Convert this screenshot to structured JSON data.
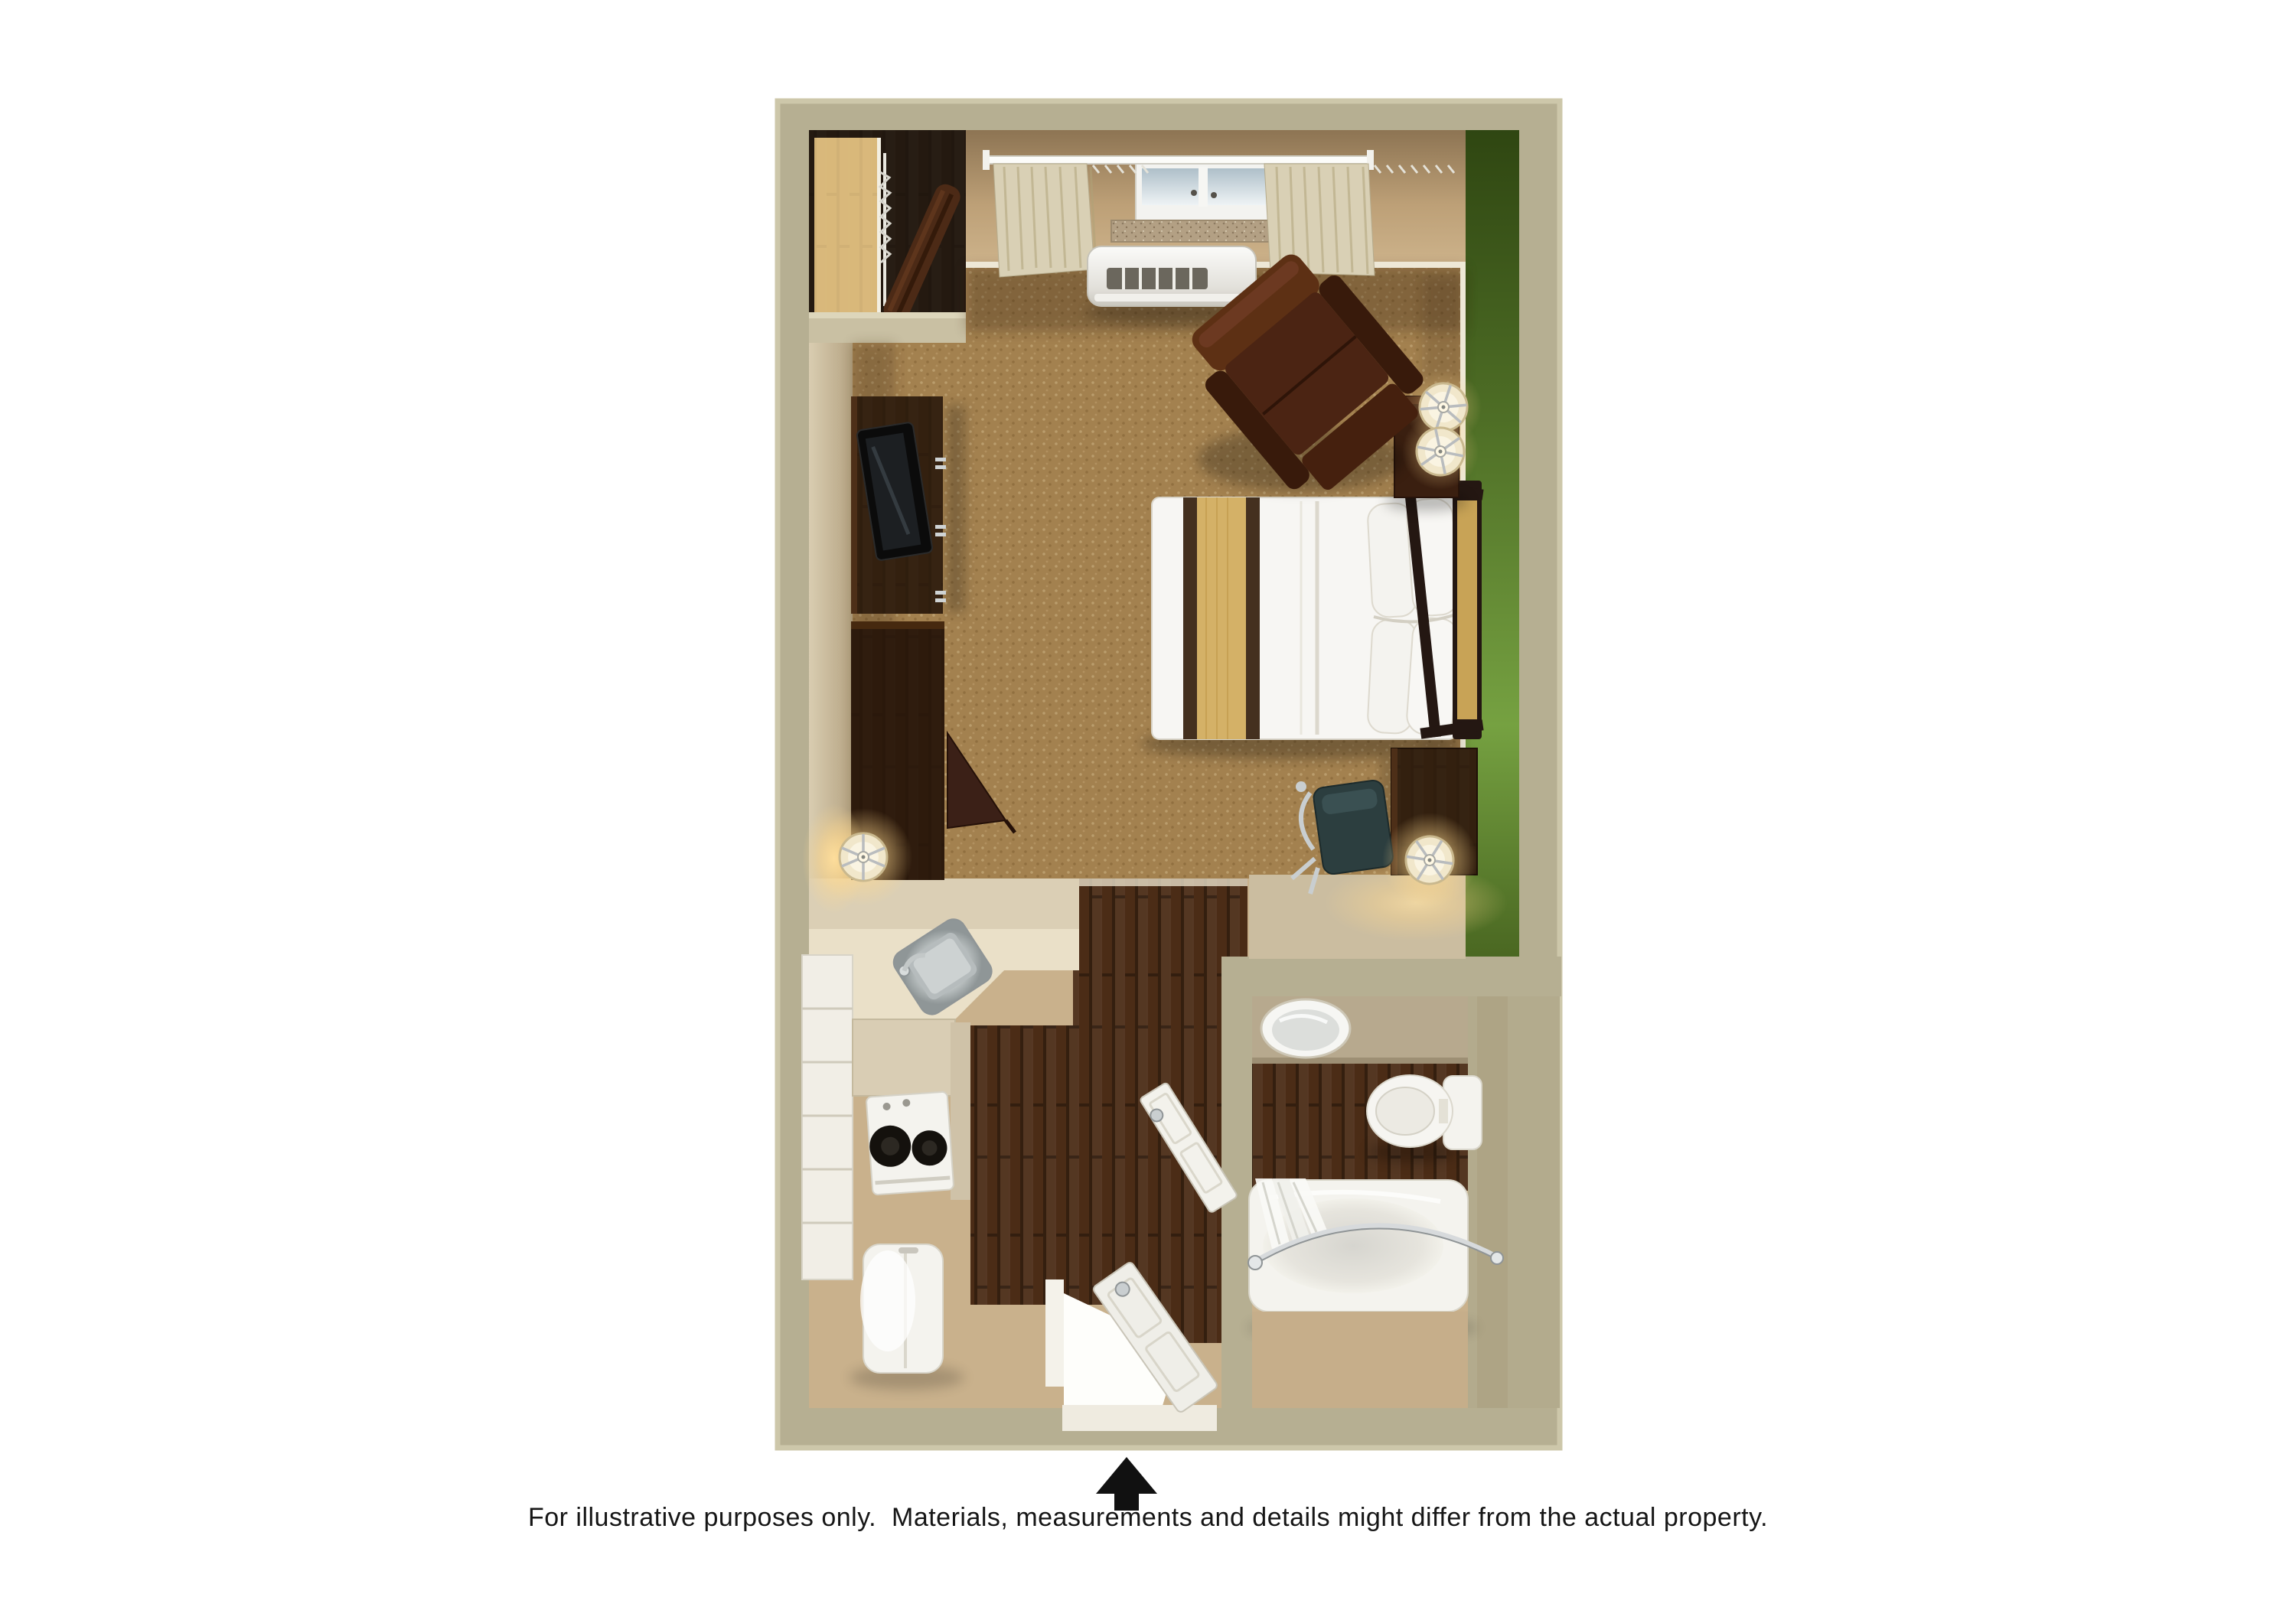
{
  "caption": {
    "text": "For illustrative purposes only.  Materials, measurements and details might differ from the actual property."
  },
  "compass": {
    "icon": "north-arrow",
    "color": "#111111"
  },
  "palette": {
    "page_bg": "#ffffff",
    "wall": "#b6af92",
    "wall_trim": "#d9d3b7",
    "wall_face_tan": "#c2a57e",
    "accent_wall_green": "#5c8030",
    "carpet": "#a3814f",
    "wood_floor": "#4b2c16",
    "entry_floor": "#c9b18c",
    "bath_tile": "#c6ae8a",
    "counter": "#dbcfb5",
    "vanity_counter": "#b7a98e",
    "cabinet_white": "#f1eee6",
    "fixture_white": "#f4f3ee",
    "furniture_wood_dark": "#3a2113",
    "armchair_brown": "#4b2413",
    "bed_white": "#f7f6f3",
    "bed_runner_gold": "#d4b167",
    "bed_stripe_brown": "#44301f",
    "headboard_panel": "#c8a356",
    "curtain": "#d9d0b5",
    "lamp_shade": "#f1e7cb",
    "lamp_glow": "#ffd98f",
    "chair_teal": "#2c3e3f",
    "stainless": "#c7cccc"
  },
  "items": [
    "closet",
    "closet-shelf",
    "closet-rod",
    "ironing-board",
    "window",
    "curtains",
    "curtain-rod",
    "ptac-unit",
    "armchair",
    "nightstand",
    "nightstand-lamps",
    "queen-bed",
    "pillows",
    "headboard",
    "tv-console",
    "tv",
    "media-cabinet",
    "table-lamp",
    "desk",
    "desk-chair",
    "desk-lamp",
    "kitchen-counter",
    "kitchen-sink",
    "stove",
    "refrigerator",
    "cabinet-column",
    "entry-door",
    "bathroom-door",
    "vanity",
    "vanity-sink",
    "toilet",
    "bathtub",
    "shower-curtain",
    "shower-curtain-rod",
    "north-arrow"
  ]
}
